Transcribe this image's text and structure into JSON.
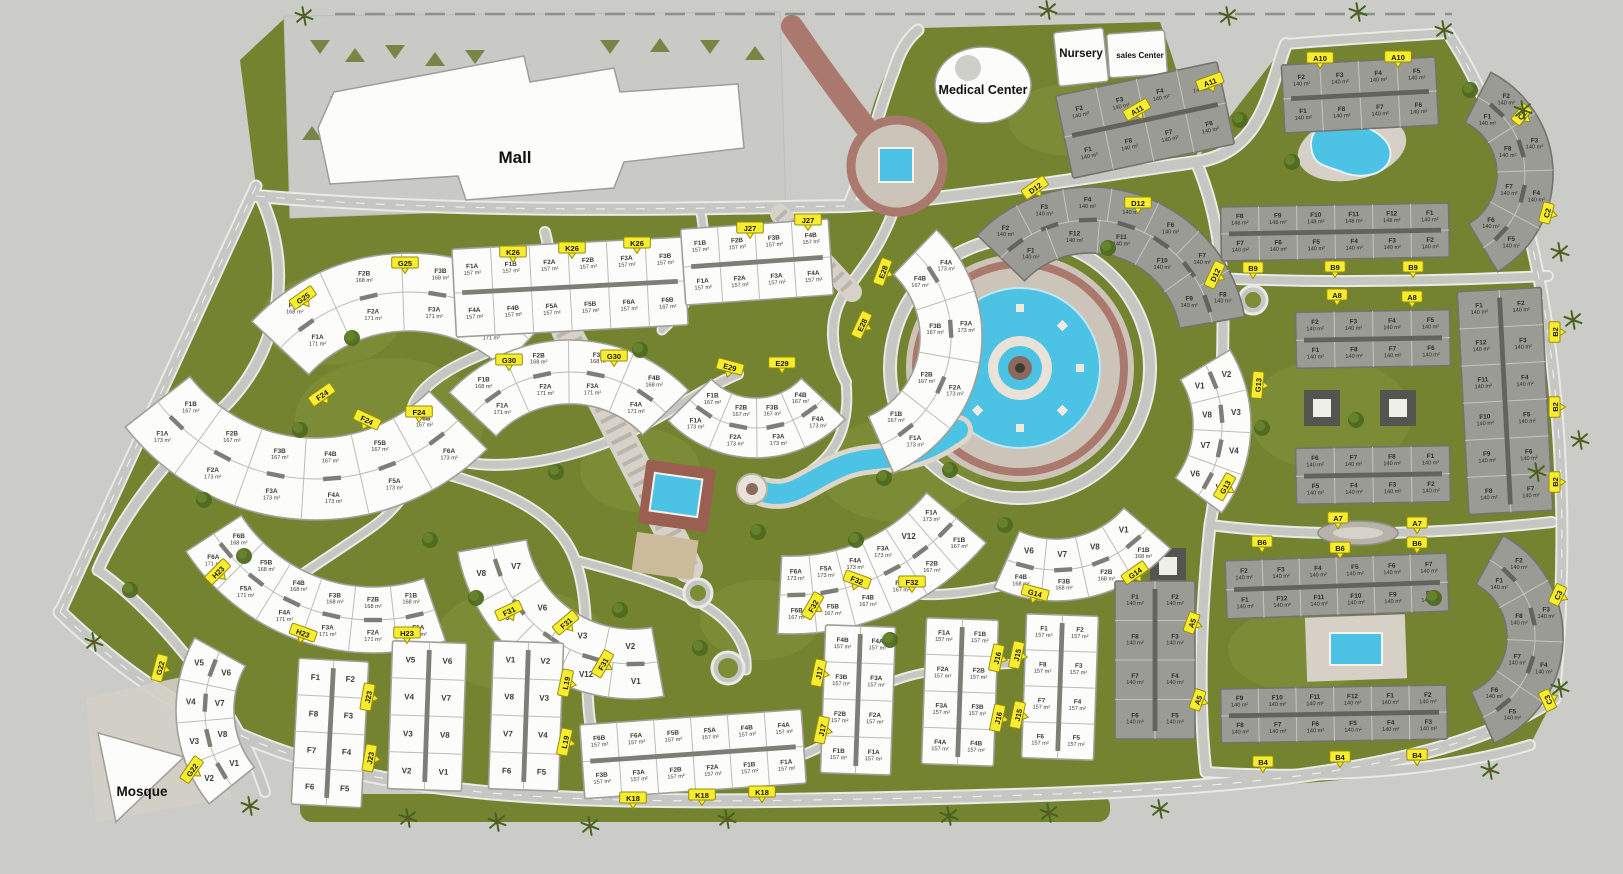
{
  "colors": {
    "background": "#cbcbc7",
    "green": "#73832f",
    "green_light": "#7d8d37",
    "road": "#c6c6c2",
    "road_edge": "#e9e9e6",
    "water": "#4cc2e4",
    "brick": "#aa786c",
    "plaza": "#cdc4b9",
    "marker_yellow": "#f6ec30",
    "building_white": "#fcfcfa",
    "building_gray": "#9b9b95",
    "deck": "#d6d0c6"
  },
  "landmarks": {
    "mall": {
      "label": "Mall"
    },
    "medical_center": {
      "label": "Medical Center"
    },
    "nursery": {
      "label": "Nursery"
    },
    "sales_center": {
      "label": "sales Center"
    },
    "mosque": {
      "label": "Mosque"
    }
  },
  "clusters": [
    {
      "id": "G25",
      "style": "white",
      "type": "arc",
      "cx": 409,
      "cy": 468,
      "r": 176,
      "band": 78,
      "a1": -137,
      "a2": -47,
      "outer": [
        "F1B|168 m²",
        "F2B|168 m²",
        "F3B|168 m²",
        "F4B|168 m²"
      ],
      "inner": [
        "F1A|171 m²",
        "F2A|171 m²",
        "F3A|171 m²",
        "F4A|171 m²"
      ]
    },
    {
      "id": "G30",
      "style": "white",
      "type": "arc",
      "cx": 570,
      "cy": 505,
      "r": 133,
      "band": 64,
      "a1": -137,
      "a2": -44,
      "outer": [
        "F1B|168 m²",
        "F2B|168 m²",
        "F3B|168 m²",
        "F4B|168 m²"
      ],
      "inner": [
        "F1A|171 m²",
        "F2A|171 m²",
        "F3A|171 m²",
        "F4A|171 m²"
      ]
    },
    {
      "id": "F24",
      "style": "white",
      "type": "arc",
      "cx": 316,
      "cy": 278,
      "r": 201,
      "band": 82,
      "a1": 142,
      "a2": 45,
      "inner": [
        "F1B|167 m²",
        "F2B|167 m²",
        "F3B|167 m²",
        "F4B|167 m²",
        "F5B|167 m²",
        "F6B|167 m²"
      ],
      "outer": [
        "F1A|173 m²",
        "F2A|173 m²",
        "F3A|173 m²",
        "F4A|173 m²",
        "F5A|173 m²",
        "F6A|173 m²"
      ]
    },
    {
      "id": "H23",
      "style": "white",
      "type": "arc",
      "cx": 373,
      "cy": 430,
      "r": 190,
      "band": 66,
      "a1": 147,
      "a2": 71,
      "inner": [
        "F6B|168 m²",
        "F5B|168 m²",
        "F4B|168 m²",
        "F3B|168 m²",
        "F2B|168 m²",
        "F1B|168 m²"
      ],
      "outer": [
        "F6A|171 m²",
        "F5A|171 m²",
        "F4A|171 m²",
        "F3A|171 m²",
        "F2A|171 m²",
        "F1A|171 m²"
      ]
    },
    {
      "id": "E28",
      "style": "white",
      "type": "arc",
      "cx": 833,
      "cy": 337,
      "r": 118,
      "band": 62,
      "a1": -46,
      "a2": 66,
      "inner": [
        "F4B|167 m²",
        "F3B|167 m²",
        "F2B|167 m²",
        "F1B|167 m²"
      ],
      "outer": [
        "F4A|173 m²",
        "F3A|173 m²",
        "F2A|173 m²",
        "F1A|173 m²"
      ]
    },
    {
      "id": "E29",
      "style": "white",
      "type": "arc",
      "cx": 756,
      "cy": 336,
      "r": 92,
      "band": 60,
      "a1": 136,
      "a2": 43,
      "inner": [
        "F1B|167 m²",
        "F2B|167 m²",
        "F3B|167 m²",
        "F4B|167 m²"
      ],
      "outer": [
        "F1A|173 m²",
        "F2A|173 m²",
        "F3A|173 m²",
        "F4A|173 m²"
      ]
    },
    {
      "id": "F32",
      "style": "white",
      "type": "arc",
      "cx": 791,
      "cy": 379,
      "r": 216,
      "band": 78,
      "a1": 93,
      "a2": 40,
      "inner": [
        "F6A|173 m²",
        "F5A|173 m²",
        "F4A|173 m²",
        "F3A|173 m²",
        "V12",
        "F1A|173 m²"
      ],
      "outer": [
        "F6B|167 m²",
        "F5B|167 m²",
        "F4B|167 m²",
        "F3B|167 m²",
        "F2B|167 m²",
        "F1B|167 m²"
      ]
    },
    {
      "id": "G14",
      "style": "white",
      "type": "arc",
      "cx": 1056,
      "cy": 449,
      "r": 121,
      "band": 62,
      "a1": 114,
      "a2": 41,
      "inner": [
        "V6",
        "V7",
        "V8",
        "V1"
      ],
      "outer": [
        "F4B|168 m²",
        "F3B|168 m²",
        "F2B|168 m²",
        "F1B|168 m²"
      ]
    },
    {
      "id": "F31",
      "style": "white",
      "type": "arc",
      "cx": 633,
      "cy": 521,
      "r": 143,
      "band": 70,
      "a1": 170,
      "a2": 80,
      "inner": [
        "V7",
        "V6",
        "V3",
        "V2"
      ],
      "outer": [
        "V8",
        "V9",
        "V4",
        "V12",
        "V1"
      ]
    },
    {
      "id": "G13",
      "style": "white",
      "type": "arc",
      "cx": 1105,
      "cy": 425,
      "r": 117,
      "band": 58,
      "a1": -31,
      "a2": 37,
      "inner": [
        "V1",
        "V8",
        "V7",
        "V6"
      ],
      "outer": [
        "V2",
        "V3",
        "V4",
        "V5"
      ]
    },
    {
      "id": "G22",
      "style": "white",
      "type": "arc",
      "cx": 325,
      "cy": 710,
      "r": 120,
      "band": 58,
      "a1": 209,
      "a2": 141,
      "inner": [
        "V6",
        "V7",
        "V8",
        "V1"
      ],
      "outer": [
        "V5",
        "V4",
        "V3",
        "V2"
      ]
    },
    {
      "id": "D12",
      "style": "gray",
      "type": "arc",
      "cx": 1090,
      "cy": 344,
      "r": 124,
      "band": 66,
      "a1": -136,
      "a2": -10,
      "outer": [
        "F2|140 m²",
        "F3|140 m²",
        "F4|140 m²",
        "F5|140 m²",
        "F6|140 m²",
        "F7|140 m²",
        "F8|140 m²"
      ],
      "inner": [
        "F1|140 m²",
        "F12|140 m²",
        "F11|140 m²",
        "F10|140 m²",
        "F9|140 m²"
      ]
    },
    {
      "id": "C2",
      "style": "gray",
      "type": "arc",
      "cx": 1439,
      "cy": 174,
      "r": 86,
      "band": 56,
      "a1": -63,
      "a2": 59,
      "inner": [
        "F1|140 m²",
        "F8|140 m²",
        "F7|140 m²",
        "F6|140 m²"
      ],
      "outer": [
        "F2|140 m²",
        "F3|140 m²",
        "F4|140 m²",
        "F5|140 m²"
      ]
    },
    {
      "id": "C3",
      "style": "gray",
      "type": "arc",
      "cx": 1447,
      "cy": 637,
      "r": 88,
      "band": 56,
      "a1": -61,
      "a2": 66,
      "inner": [
        "F1|140 m²",
        "F8|140 m²",
        "F7|140 m²",
        "F6|140 m²"
      ],
      "outer": [
        "F2|140 m²",
        "F3|140 m²",
        "F4|140 m²",
        "F5|140 m²"
      ]
    },
    {
      "id": "K26",
      "style": "white",
      "type": "row",
      "x": 570,
      "y": 287,
      "w": 232,
      "h": 88,
      "rot": -3,
      "top": [
        "F1A|157 m²",
        "F1B|157 m²",
        "F2A|157 m²",
        "F2B|157 m²",
        "F3A|157 m²",
        "F3B|157 m²"
      ],
      "bottom": [
        "F4A|157 m²",
        "F4B|157 m²",
        "F5A|157 m²",
        "F5B|157 m²",
        "F6A|157 m²",
        "F6B|167 m²"
      ]
    },
    {
      "id": "J27",
      "style": "white",
      "type": "row",
      "x": 757,
      "y": 262,
      "w": 148,
      "h": 76,
      "rot": -4,
      "top": [
        "F1B|157 m²",
        "F2B|157 m²",
        "F3B|157 m²",
        "F4B|157 m²"
      ],
      "bottom": [
        "F1A|157 m²",
        "F2A|157 m²",
        "F3A|157 m²",
        "F4A|157 m²"
      ]
    },
    {
      "id": "K18",
      "style": "white",
      "type": "row",
      "x": 693,
      "y": 754,
      "w": 222,
      "h": 74,
      "rot": -4,
      "top": [
        "F6B|157 m²",
        "F6A|157 m²",
        "F5B|157 m²",
        "F5A|157 m²",
        "F4B|157 m²",
        "F4A|157 m²"
      ],
      "bottom": [
        "F3B|157 m²",
        "F3A|157 m²",
        "F2B|157 m²",
        "F2A|157 m²",
        "F1B|157 m²",
        "F1A|157 m²"
      ]
    },
    {
      "id": "B9",
      "style": "gray",
      "type": "row",
      "x": 1335,
      "y": 232,
      "w": 228,
      "h": 54,
      "rot": -1,
      "top": [
        "F8|148 m²",
        "F9|148 m²",
        "F10|148 m²",
        "F11|148 m²",
        "F12|148 m²",
        "F1|140 m²"
      ],
      "bottom": [
        "F7|140 m²",
        "F6|140 m²",
        "F5|140 m²",
        "F4|140 m²",
        "F3|140 m²",
        "F2|140 m²"
      ]
    },
    {
      "id": "A10",
      "style": "gray",
      "type": "row",
      "x": 1360,
      "y": 95,
      "w": 154,
      "h": 68,
      "rot": -3,
      "top": [
        "F2|140 m²",
        "F3|140 m²",
        "F4|140 m²",
        "F5|140 m²"
      ],
      "bottom": [
        "F1|140 m²",
        "F8|140 m²",
        "F7|140 m²",
        "F6|140 m²"
      ]
    },
    {
      "id": "A11",
      "style": "gray",
      "type": "row",
      "x": 1145,
      "y": 120,
      "w": 165,
      "h": 84,
      "rot": -12,
      "top": [
        "F2|140 m²",
        "F3|140 m²",
        "F4|140 m²",
        "F5|140 m²"
      ],
      "bottom": [
        "F1|140 m²",
        "F8|140 m²",
        "F7|140 m²",
        "F6|140 m²"
      ]
    },
    {
      "id": "A8",
      "style": "gray",
      "type": "row",
      "x": 1373,
      "y": 339,
      "w": 154,
      "h": 56,
      "rot": -1,
      "top": [
        "F2|140 m²",
        "F3|140 m²",
        "F4|140 m²",
        "F5|140 m²"
      ],
      "bottom": [
        "F1|140 m²",
        "F8|140 m²",
        "F7|140 m²",
        "F6|140 m²"
      ]
    },
    {
      "id": "A8b",
      "style": "gray",
      "type": "row",
      "x": 1373,
      "y": 475,
      "w": 154,
      "h": 56,
      "rot": -1,
      "top": [
        "F6|140 m²",
        "F7|140 m²",
        "F8|140 m²",
        "F1|140 m²"
      ],
      "bottom": [
        "F5|140 m²",
        "F4|140 m²",
        "F3|140 m²",
        "F2|140 m²"
      ]
    },
    {
      "id": "B6",
      "style": "gray",
      "type": "row",
      "x": 1337,
      "y": 586,
      "w": 222,
      "h": 58,
      "rot": -2,
      "top": [
        "F2|140 m²",
        "F3|140 m²",
        "F4|140 m²",
        "F5|140 m²",
        "F6|140 m²",
        "F7|140 m²"
      ],
      "bottom": [
        "F1|140 m²",
        "F12|140 m²",
        "F11|140 m²",
        "F10|140 m²",
        "F9|140 m²",
        "F8|140 m²"
      ]
    },
    {
      "id": "B4",
      "style": "gray",
      "type": "row",
      "x": 1334,
      "y": 714,
      "w": 226,
      "h": 54,
      "rot": -1,
      "top": [
        "F9|140 m²",
        "F10|140 m²",
        "F11|140 m²",
        "F12|140 m²",
        "F1|140 m²",
        "F2|140 m²"
      ],
      "bottom": [
        "F8|140 m²",
        "F7|140 m²",
        "F6|140 m²",
        "F5|140 m²",
        "F4|140 m²",
        "F3|140 m²"
      ]
    },
    {
      "id": "B2",
      "style": "gray",
      "type": "block",
      "x": 1505,
      "y": 401,
      "w": 84,
      "h": 223,
      "rot": -3,
      "rows": [
        [
          "F1|140 m²",
          "F2|140 m²"
        ],
        [
          "F12|140 m²",
          "F3|140 m²"
        ],
        [
          "F11|140 m²",
          "F4|140 m²"
        ],
        [
          "F10|140 m²",
          "F5|140 m²"
        ],
        [
          "F9|140 m²",
          "F6|140 m²"
        ],
        [
          "F8|140 m²",
          "F7|140 m²"
        ]
      ]
    },
    {
      "id": "A5",
      "style": "gray",
      "type": "block",
      "x": 1155,
      "y": 660,
      "w": 80,
      "h": 158,
      "rot": 0,
      "rows": [
        [
          "F1|140 m²",
          "F2|140 m²"
        ],
        [
          "F8|140 m²",
          "F3|140 m²"
        ],
        [
          "F7|140 m²",
          "F4|140 m²"
        ],
        [
          "F6|140 m²",
          "F5|140 m²"
        ]
      ]
    },
    {
      "id": "J23",
      "style": "white",
      "type": "block",
      "x": 330,
      "y": 733,
      "w": 70,
      "h": 146,
      "rot": 3,
      "rows": [
        [
          "F1",
          "F2"
        ],
        [
          "F8",
          "F3"
        ],
        [
          "F7",
          "F4"
        ],
        [
          "F6",
          "F5"
        ]
      ]
    },
    {
      "id": "",
      "style": "white",
      "type": "block",
      "x": 427,
      "y": 716,
      "w": 74,
      "h": 148,
      "rot": 2,
      "rows": [
        [
          "V5",
          "V6"
        ],
        [
          "V4",
          "V7"
        ],
        [
          "V3",
          "V8"
        ],
        [
          "V2",
          "V1"
        ]
      ]
    },
    {
      "id": "L19",
      "style": "white",
      "type": "block",
      "x": 526,
      "y": 716,
      "w": 70,
      "h": 148,
      "rot": 2,
      "rows": [
        [
          "V1",
          "V2"
        ],
        [
          "V8",
          "V3"
        ],
        [
          "V7",
          "V4"
        ],
        [
          "F6",
          "F5"
        ]
      ]
    },
    {
      "id": "J17",
      "style": "white",
      "type": "block",
      "x": 858,
      "y": 700,
      "w": 70,
      "h": 148,
      "rot": 2,
      "rows": [
        [
          "F4B|157 m²",
          "F4A|157 m²"
        ],
        [
          "F3B|157 m²",
          "F3A|157 m²"
        ],
        [
          "F2B|157 m²",
          "F2A|157 m²"
        ],
        [
          "F1B|157 m²",
          "F1A|157 m²"
        ]
      ]
    },
    {
      "id": "J16",
      "style": "white",
      "type": "block",
      "x": 960,
      "y": 692,
      "w": 72,
      "h": 146,
      "rot": 2,
      "rows": [
        [
          "F1A|157 m²",
          "F1B|157 m²"
        ],
        [
          "F2A|157 m²",
          "F2B|157 m²"
        ],
        [
          "F3A|157 m²",
          "F3B|157 m²"
        ],
        [
          "F4A|157 m²",
          "F4B|157 m²"
        ]
      ]
    },
    {
      "id": "J15",
      "style": "white",
      "type": "block",
      "x": 1060,
      "y": 687,
      "w": 72,
      "h": 144,
      "rot": 2,
      "rows": [
        [
          "F1|157 m²",
          "F2|157 m²"
        ],
        [
          "F8|157 m²",
          "F3|157 m²"
        ],
        [
          "F7|157 m²",
          "F4|157 m²"
        ],
        [
          "F6|157 m²",
          "F5|157 m²"
        ]
      ]
    }
  ],
  "markers": [
    {
      "t": "G25",
      "x": 303,
      "y": 298,
      "rot": -35
    },
    {
      "t": "G25",
      "x": 405,
      "y": 263,
      "rot": 0
    },
    {
      "t": "K26",
      "x": 513,
      "y": 252,
      "rot": 0
    },
    {
      "t": "K26",
      "x": 572,
      "y": 248,
      "rot": 0
    },
    {
      "t": "K26",
      "x": 637,
      "y": 243,
      "rot": 0
    },
    {
      "t": "J27",
      "x": 750,
      "y": 228,
      "rot": 0
    },
    {
      "t": "J27",
      "x": 808,
      "y": 220,
      "rot": 0
    },
    {
      "t": "G30",
      "x": 509,
      "y": 360,
      "rot": 0
    },
    {
      "t": "G30",
      "x": 614,
      "y": 356,
      "rot": 0
    },
    {
      "t": "F24",
      "x": 322,
      "y": 395,
      "rot": -35
    },
    {
      "t": "F24",
      "x": 367,
      "y": 420,
      "rot": 25
    },
    {
      "t": "F24",
      "x": 419,
      "y": 412,
      "rot": 0
    },
    {
      "t": "H23",
      "x": 218,
      "y": 572,
      "rot": -45
    },
    {
      "t": "H23",
      "x": 303,
      "y": 633,
      "rot": 20
    },
    {
      "t": "H23",
      "x": 407,
      "y": 633,
      "rot": 0
    },
    {
      "t": "E28",
      "x": 883,
      "y": 272,
      "rot": -70
    },
    {
      "t": "E28",
      "x": 862,
      "y": 325,
      "rot": -65
    },
    {
      "t": "E29",
      "x": 730,
      "y": 367,
      "rot": 15
    },
    {
      "t": "E29",
      "x": 782,
      "y": 363,
      "rot": 0
    },
    {
      "t": "F32",
      "x": 813,
      "y": 606,
      "rot": -60
    },
    {
      "t": "F32",
      "x": 857,
      "y": 580,
      "rot": 20
    },
    {
      "t": "F32",
      "x": 912,
      "y": 582,
      "rot": 0
    },
    {
      "t": "G14",
      "x": 1035,
      "y": 593,
      "rot": 15
    },
    {
      "t": "G14",
      "x": 1135,
      "y": 573,
      "rot": -35
    },
    {
      "t": "F31",
      "x": 509,
      "y": 611,
      "rot": -25
    },
    {
      "t": "F31",
      "x": 566,
      "y": 623,
      "rot": -40
    },
    {
      "t": "F31",
      "x": 603,
      "y": 664,
      "rot": -60
    },
    {
      "t": "G13",
      "x": 1258,
      "y": 385,
      "rot": -85
    },
    {
      "t": "G13",
      "x": 1225,
      "y": 487,
      "rot": -60
    },
    {
      "t": "G22",
      "x": 160,
      "y": 668,
      "rot": -75
    },
    {
      "t": "G22",
      "x": 192,
      "y": 770,
      "rot": -55
    },
    {
      "t": "J23",
      "x": 368,
      "y": 697,
      "rot": -80
    },
    {
      "t": "J23",
      "x": 370,
      "y": 758,
      "rot": -80
    },
    {
      "t": "L19",
      "x": 566,
      "y": 683,
      "rot": -78
    },
    {
      "t": "L19",
      "x": 565,
      "y": 742,
      "rot": -78
    },
    {
      "t": "K18",
      "x": 633,
      "y": 798,
      "rot": 0
    },
    {
      "t": "K18",
      "x": 702,
      "y": 795,
      "rot": 0
    },
    {
      "t": "K18",
      "x": 762,
      "y": 792,
      "rot": 0
    },
    {
      "t": "J17",
      "x": 819,
      "y": 673,
      "rot": -78
    },
    {
      "t": "J17",
      "x": 822,
      "y": 730,
      "rot": -78
    },
    {
      "t": "J16",
      "x": 997,
      "y": 658,
      "rot": -78
    },
    {
      "t": "J16",
      "x": 998,
      "y": 718,
      "rot": -78
    },
    {
      "t": "J15",
      "x": 1017,
      "y": 655,
      "rot": -78
    },
    {
      "t": "J15",
      "x": 1018,
      "y": 715,
      "rot": -78
    },
    {
      "t": "A5",
      "x": 1192,
      "y": 623,
      "rot": -70
    },
    {
      "t": "A5",
      "x": 1198,
      "y": 700,
      "rot": -70
    },
    {
      "t": "D12",
      "x": 1035,
      "y": 188,
      "rot": -35
    },
    {
      "t": "D12",
      "x": 1138,
      "y": 203,
      "rot": 0
    },
    {
      "t": "D12",
      "x": 1215,
      "y": 275,
      "rot": -65
    },
    {
      "t": "B9",
      "x": 1253,
      "y": 268,
      "rot": 0
    },
    {
      "t": "B9",
      "x": 1335,
      "y": 267,
      "rot": 0
    },
    {
      "t": "B9",
      "x": 1413,
      "y": 267,
      "rot": 0
    },
    {
      "t": "A10",
      "x": 1320,
      "y": 58,
      "rot": 0
    },
    {
      "t": "A10",
      "x": 1398,
      "y": 57,
      "rot": 0
    },
    {
      "t": "A11",
      "x": 1137,
      "y": 110,
      "rot": -30
    },
    {
      "t": "A11",
      "x": 1210,
      "y": 82,
      "rot": -20
    },
    {
      "t": "C2",
      "x": 1522,
      "y": 115,
      "rot": -50
    },
    {
      "t": "C2",
      "x": 1547,
      "y": 213,
      "rot": -75
    },
    {
      "t": "A8",
      "x": 1337,
      "y": 295,
      "rot": 0
    },
    {
      "t": "A8",
      "x": 1412,
      "y": 297,
      "rot": 0
    },
    {
      "t": "B2",
      "x": 1555,
      "y": 332,
      "rot": -90
    },
    {
      "t": "B2",
      "x": 1555,
      "y": 407,
      "rot": -90
    },
    {
      "t": "B2",
      "x": 1555,
      "y": 482,
      "rot": -90
    },
    {
      "t": "A7",
      "x": 1338,
      "y": 518,
      "rot": 0
    },
    {
      "t": "A7",
      "x": 1417,
      "y": 523,
      "rot": 0
    },
    {
      "t": "B6",
      "x": 1262,
      "y": 542,
      "rot": 0
    },
    {
      "t": "B6",
      "x": 1340,
      "y": 548,
      "rot": 0
    },
    {
      "t": "B6",
      "x": 1417,
      "y": 543,
      "rot": 0
    },
    {
      "t": "B4",
      "x": 1263,
      "y": 762,
      "rot": 0
    },
    {
      "t": "B4",
      "x": 1340,
      "y": 757,
      "rot": 0
    },
    {
      "t": "B4",
      "x": 1417,
      "y": 755,
      "rot": 0
    },
    {
      "t": "C3",
      "x": 1558,
      "y": 595,
      "rot": -65
    },
    {
      "t": "C3",
      "x": 1548,
      "y": 700,
      "rot": -115
    }
  ]
}
